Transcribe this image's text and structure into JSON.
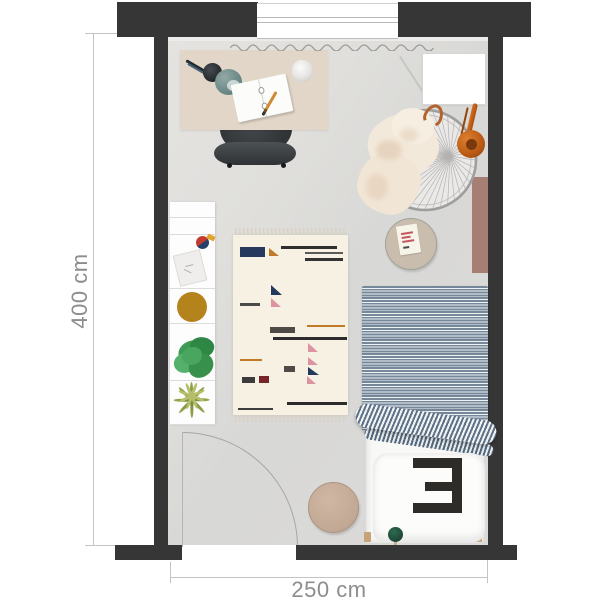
{
  "plan": {
    "type": "bedroom-floor-plan-top-view",
    "labels": {
      "height_dimension": "400 cm",
      "width_dimension": "250 cm"
    },
    "bed": {
      "pillow_numeral": "3"
    },
    "palette": {
      "wall": "#363636",
      "floor": "#dadad8",
      "desk": "#e1d6c7",
      "lamp_shade_teal": "#6d8b89",
      "shelf_white": "#fdfdfd",
      "decor_mustard": "#b5831c",
      "plant_green": "#3e9b55",
      "rug_cream": "#f7f1e4",
      "rug_navy": "#273a5e",
      "rug_ochre": "#c07b28",
      "rug_maroon": "#77242a",
      "rug_pink": "#dc93a2",
      "duvet_stripe_blue": "#76879a",
      "headphones_orange": "#b85a15",
      "wall_panel_mauve": "#a77e74",
      "side_table_tan": "#c9bead",
      "pouf_tan": "#c2a995",
      "pompom_green": "#1c4434",
      "dimension_text_gray": "#8d8d8d"
    },
    "objects": [
      "window",
      "radiator-squiggle",
      "desk",
      "desk-lamp",
      "notebook",
      "pencil",
      "crumpled-paper",
      "desk-chair",
      "leaning-stick",
      "wall-board",
      "hanging-chair",
      "sheepskin-throw",
      "copper-hook",
      "headphones",
      "wall-panel",
      "side-table",
      "table-card",
      "shelf",
      "spinning-top-toy",
      "paper-card",
      "decor-circle",
      "bushy-plant",
      "spiky-plant",
      "rug",
      "bed",
      "striped-duvet",
      "duvet-fold",
      "pillow",
      "pompom",
      "pouf",
      "door-swing"
    ]
  }
}
